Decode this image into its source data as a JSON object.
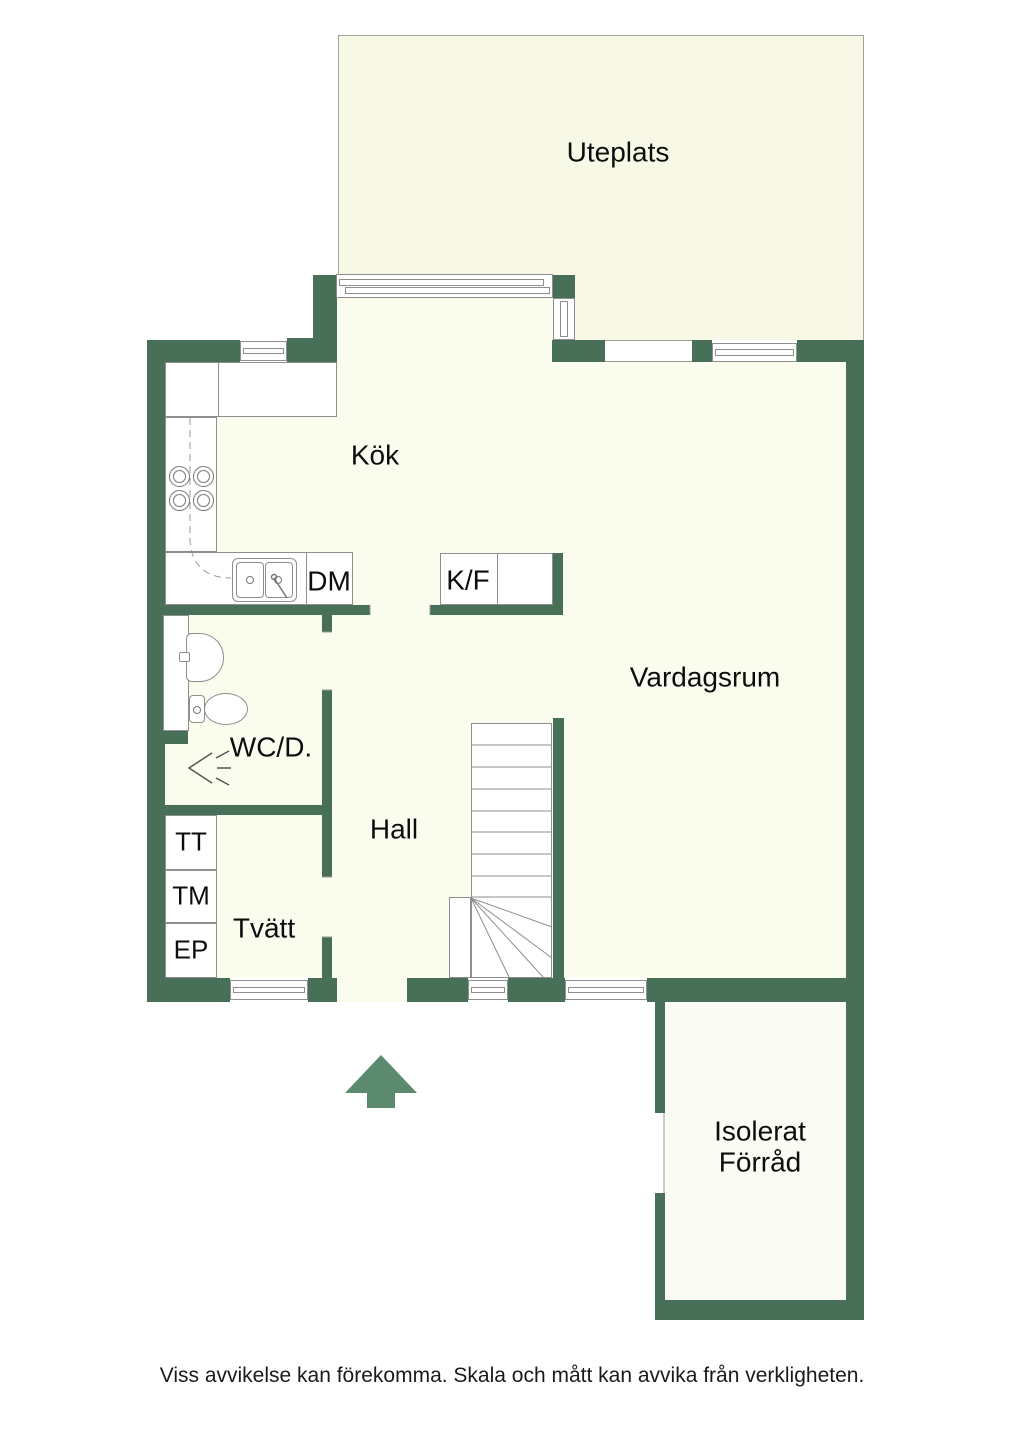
{
  "colors": {
    "wall": "#487059",
    "floor": "#fafcee",
    "patio": "#f7f8e6",
    "storage_floor": "#fafbf2",
    "arrow": "#5c8a6e"
  },
  "labels": {
    "patio": "Uteplats",
    "kitchen": "Kök",
    "dishwasher": "DM",
    "fridge_freezer": "K/F",
    "living_room": "Vardagsrum",
    "wc": "WC/D.",
    "hall": "Hall",
    "tumble_dryer": "TT",
    "washing_machine": "TM",
    "electrical_panel": "EP",
    "laundry": "Tvätt",
    "storage": "Isolerat Förråd",
    "disclaimer": "Viss avvikelse kan förekomma. Skala och mått kan avvika från verkligheten."
  }
}
